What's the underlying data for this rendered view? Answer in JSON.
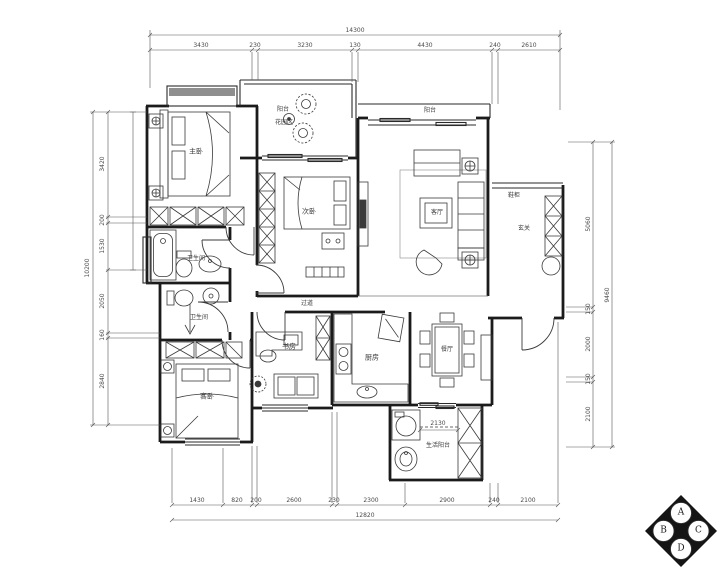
{
  "labels": {
    "master_bedroom": "主卧",
    "garden_line1": "阳台",
    "garden_line2": "花园区",
    "bedroom2": "次卧",
    "living_balcony": "阳台",
    "living": "客厅",
    "shoe_cabinet": "鞋柜",
    "entry": "玄关",
    "hallway": "过道",
    "study": "书房",
    "kitchen": "厨房",
    "dining": "餐厅",
    "bath_master": "卫生间",
    "bath_guest": "卫生间",
    "bedroom3": "客卧",
    "laundry": "生活阳台"
  },
  "dimensions": {
    "top": {
      "segments": [
        "3430",
        "230",
        "3230",
        "130",
        "4430",
        "240",
        "2610"
      ],
      "total": "14300"
    },
    "bottom": {
      "segments": [
        "1430",
        "820",
        "200",
        "2600",
        "230",
        "2300",
        "2900",
        "240",
        "2100"
      ],
      "total": "12820"
    },
    "left": {
      "segments": [
        "3420",
        "200",
        "1530",
        "2050",
        "160",
        "2840"
      ],
      "total": "10200"
    },
    "right": {
      "segments": [
        "5060",
        "150",
        "2000",
        "150",
        "2100"
      ],
      "total": "9460"
    },
    "inner": {
      "laundry_width": "2130"
    }
  },
  "compass": {
    "top": "A",
    "left": "B",
    "right": "C",
    "bottom": "D"
  },
  "colors": {
    "wall": "#1b1b1b",
    "furniture": "#3a3a3a",
    "bay_fill": "#8f8f8f"
  }
}
